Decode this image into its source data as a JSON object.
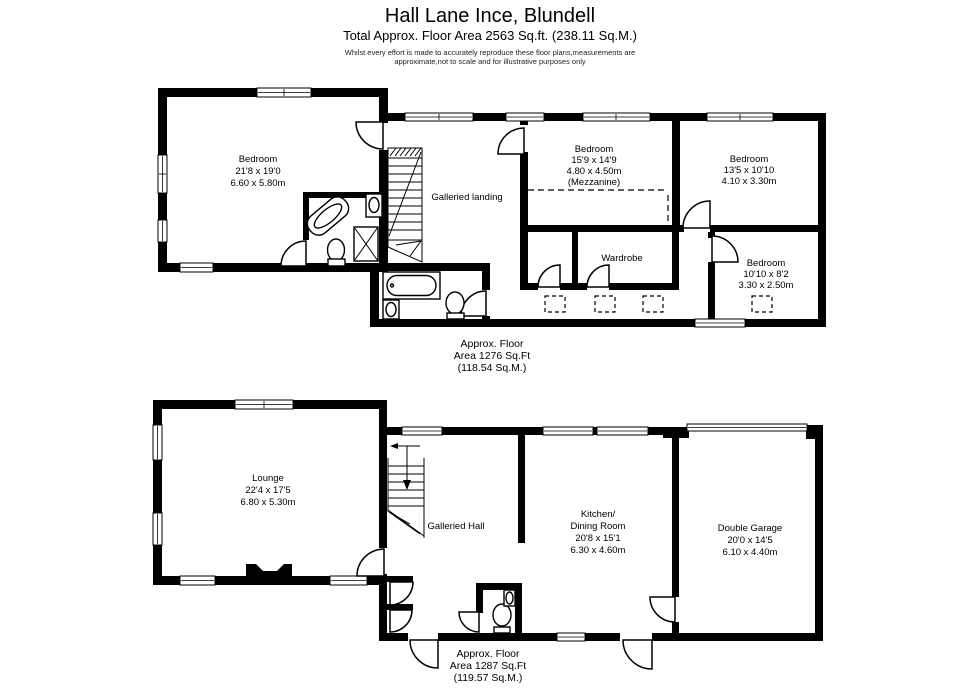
{
  "header": {
    "title": "Hall Lane Ince, Blundell",
    "subtitle": "Total Approx. Floor Area 2563 Sq.ft. (238.11 Sq.M.)",
    "disclaimer_line1": "Whilst every effort is made to accurately reproduce these floor plans,measurements are",
    "disclaimer_line2": "approximate,not to scale and for illustrative purposes only"
  },
  "first_floor": {
    "area": {
      "line1": "Approx. Floor",
      "line2": "Area 1276 Sq.Ft",
      "line3": "(118.54 Sq.M.)"
    },
    "rooms": {
      "master_bedroom": {
        "name": "Bedroom",
        "imperial": "21'8 x 19'0",
        "metric": "6.60 x 5.80m"
      },
      "landing": {
        "name": "Galleried landing"
      },
      "mezzanine_bedroom": {
        "name": "Bedroom",
        "imperial": "15'9 x 14'9",
        "metric": "4.80 x 4.50m",
        "note": "(Mezzanine)"
      },
      "bedroom_three": {
        "name": "Bedroom",
        "imperial": "13'5 x 10'10",
        "metric": "4.10 x 3.30m"
      },
      "bedroom_four": {
        "name": "Bedroom",
        "imperial": "10'10 x 8'2",
        "metric": "3.30 x 2.50m"
      },
      "wardrobe": {
        "name": "Wardrobe"
      }
    }
  },
  "ground_floor": {
    "area": {
      "line1": "Approx. Floor",
      "line2": "Area 1287 Sq.Ft",
      "line3": "(119.57 Sq.M.)"
    },
    "rooms": {
      "lounge": {
        "name": "Lounge",
        "imperial": "22'4 x 17'5",
        "metric": "6.80 x 5.30m"
      },
      "hall": {
        "name": "Galleried Hall"
      },
      "kitchen_dining": {
        "name_line1": "Kitchen/",
        "name_line2": "Dining Room",
        "imperial": "20'8 x 15'1",
        "metric": "6.30 x 4.60m"
      },
      "garage": {
        "name": "Double Garage",
        "imperial": "20'0 x 14'5",
        "metric": "6.10 x 4.40m"
      }
    }
  },
  "colors": {
    "wall": "#000000",
    "background": "#ffffff",
    "text": "#000000"
  }
}
